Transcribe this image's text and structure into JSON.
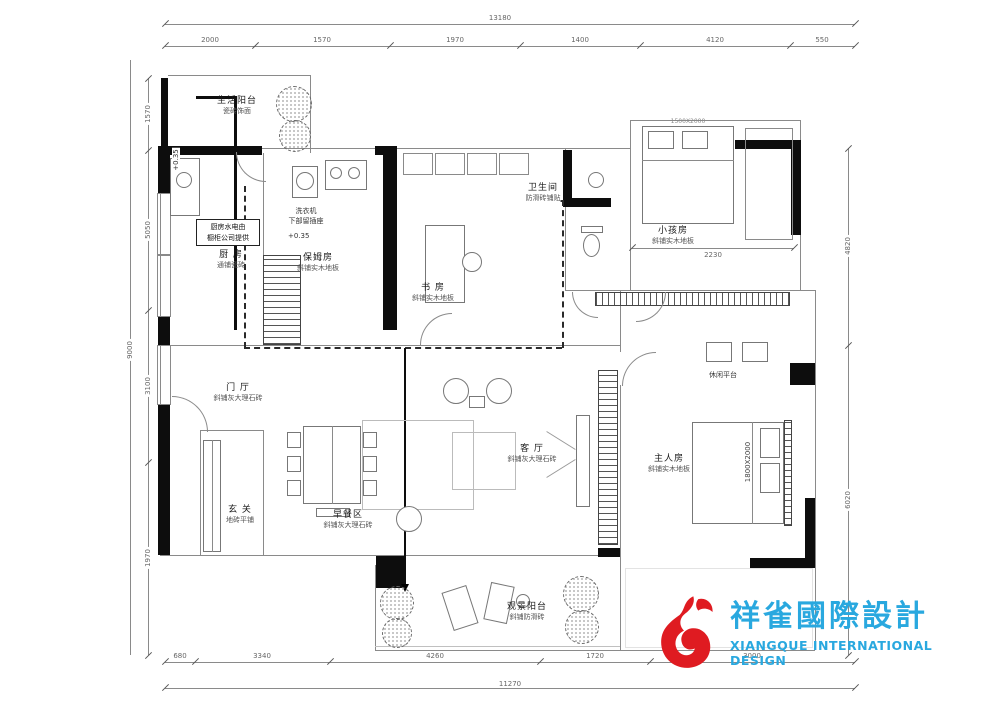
{
  "logo": {
    "cn": "祥雀國際設計",
    "en": "XIANGQUE INTERNATIONAL DESIGN",
    "red": "#df1b21",
    "cyan": "#29a8df"
  },
  "rooms": {
    "life_balcony": {
      "name": "生活阳台",
      "sub": "瓷砖饰面"
    },
    "kitchen": {
      "name": "厨 房",
      "sub": "通铺瓷砖"
    },
    "maid": {
      "name": "保姆房",
      "sub": "斜铺实木地板"
    },
    "study": {
      "name": "书 房",
      "sub": "斜铺实木地板"
    },
    "bath": {
      "name": "卫生间",
      "sub": "防滑砖铺贴"
    },
    "kids": {
      "name": "小孩房",
      "sub": "斜铺实木地板"
    },
    "master": {
      "name": "主人房",
      "sub": "斜铺实木地板"
    },
    "hall": {
      "name": "门 厅",
      "sub": "斜铺灰大理石砖"
    },
    "living": {
      "name": "客 厅",
      "sub": "斜铺灰大理石砖"
    },
    "breakfast": {
      "name": "早餐区",
      "sub": "斜铺灰大理石砖"
    },
    "foyer": {
      "name": "玄 关",
      "sub": "地砖平铺"
    },
    "view_balcony": {
      "name": "观景阳台",
      "sub": "斜铺防滑砖"
    },
    "leisure": {
      "name": "休闲平台"
    }
  },
  "notes": {
    "kitchen1": "厨房水电由",
    "kitchen2": "橱柜公司提供",
    "washer1": "洗衣机",
    "washer2": "下部留插座",
    "level1": "+0.35",
    "level2": "+0.35",
    "bed_master": "1800X2000",
    "bed_kids": "1500X2000",
    "closet": "2230"
  },
  "dims": {
    "top_total": "13180",
    "top": [
      "2000",
      "1570",
      "1970",
      "1400",
      "4120",
      "550"
    ],
    "left_total": "9000",
    "left": [
      "1570",
      "5050",
      "3100",
      "1970"
    ],
    "right": [
      "4820",
      "6020"
    ],
    "bottom": [
      "680",
      "3340",
      "4260",
      "1720",
      "3000"
    ],
    "bottom_total": "11270"
  }
}
